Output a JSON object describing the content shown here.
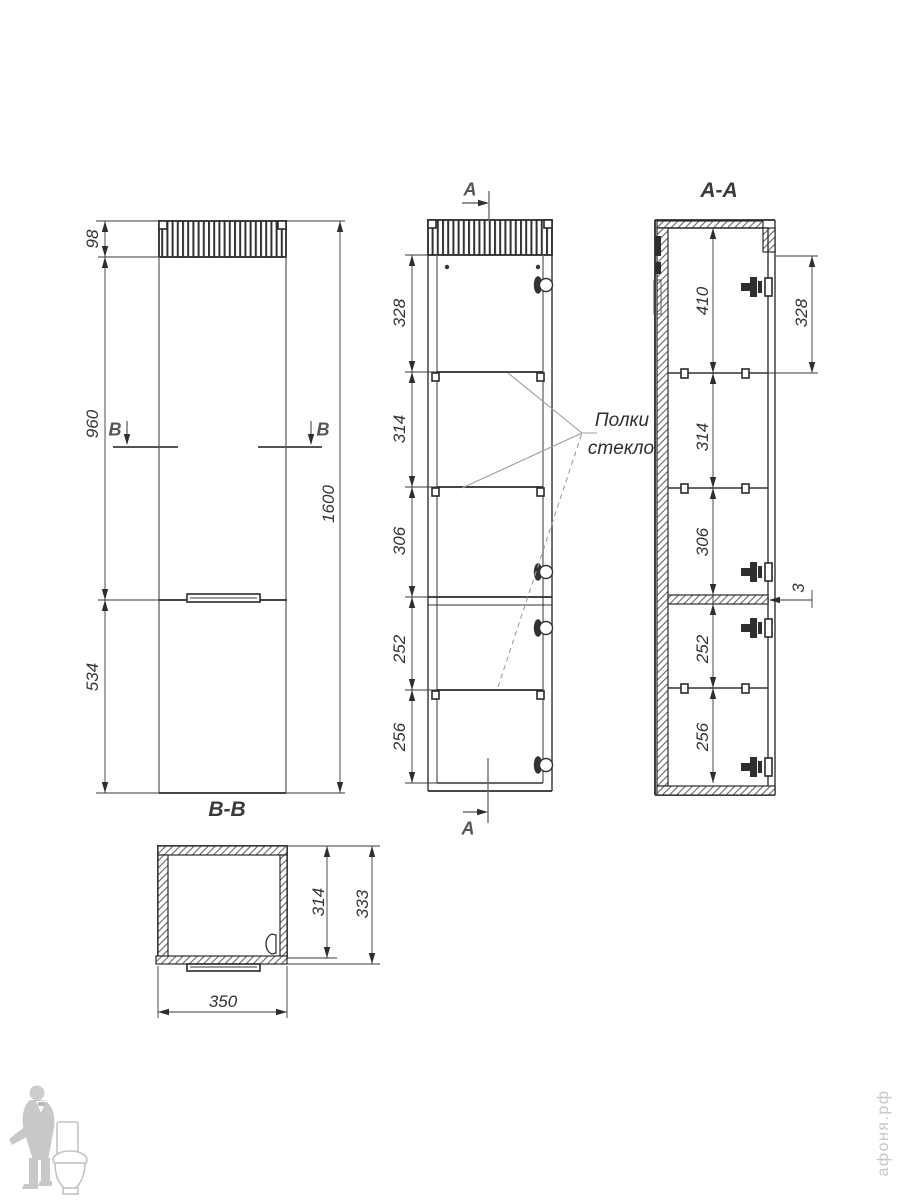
{
  "front_view": {
    "title": "B-B",
    "section_marker": "B",
    "dims": {
      "strip": "98",
      "upper": "960",
      "lower": "534",
      "total": "1600"
    }
  },
  "side_view": {
    "section_marker": "A",
    "dims": [
      "328",
      "314",
      "306",
      "252",
      "256"
    ]
  },
  "section_view": {
    "title": "A-A",
    "dims": [
      "410",
      "314",
      "306",
      "252",
      "256"
    ],
    "door_dim": "328",
    "gap_dim": "3"
  },
  "plan_view": {
    "dims": {
      "inner_depth": "314",
      "depth": "333",
      "width": "350"
    }
  },
  "notes": {
    "shelves_line1": "Полки",
    "shelves_line2": "стекло"
  },
  "watermark": {
    "site": "афоня.рф"
  }
}
